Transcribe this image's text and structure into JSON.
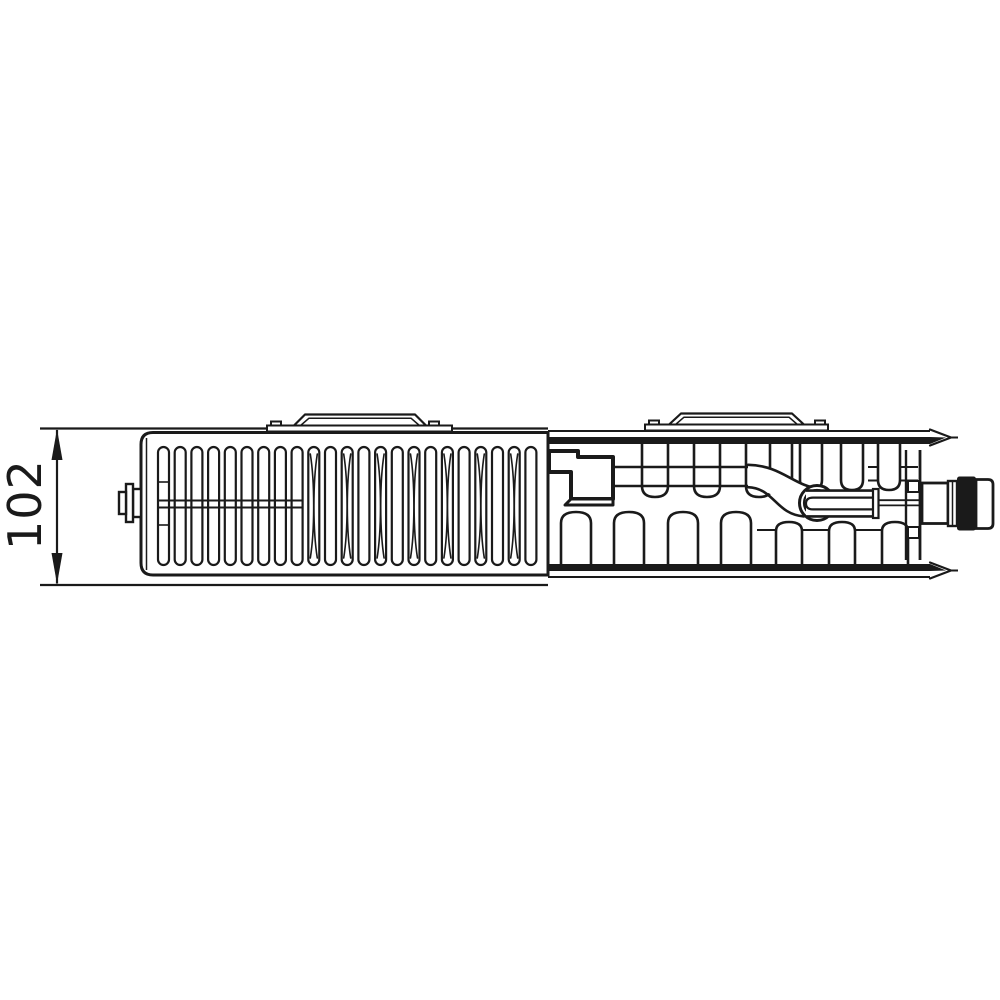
{
  "drawing": {
    "dimension": {
      "label": "102"
    },
    "colors": {
      "line": "#1a1a1a",
      "background": "#ffffff",
      "cap_fill": "#1a1a1a",
      "panel_band_fill": "#1a1a1a"
    }
  }
}
